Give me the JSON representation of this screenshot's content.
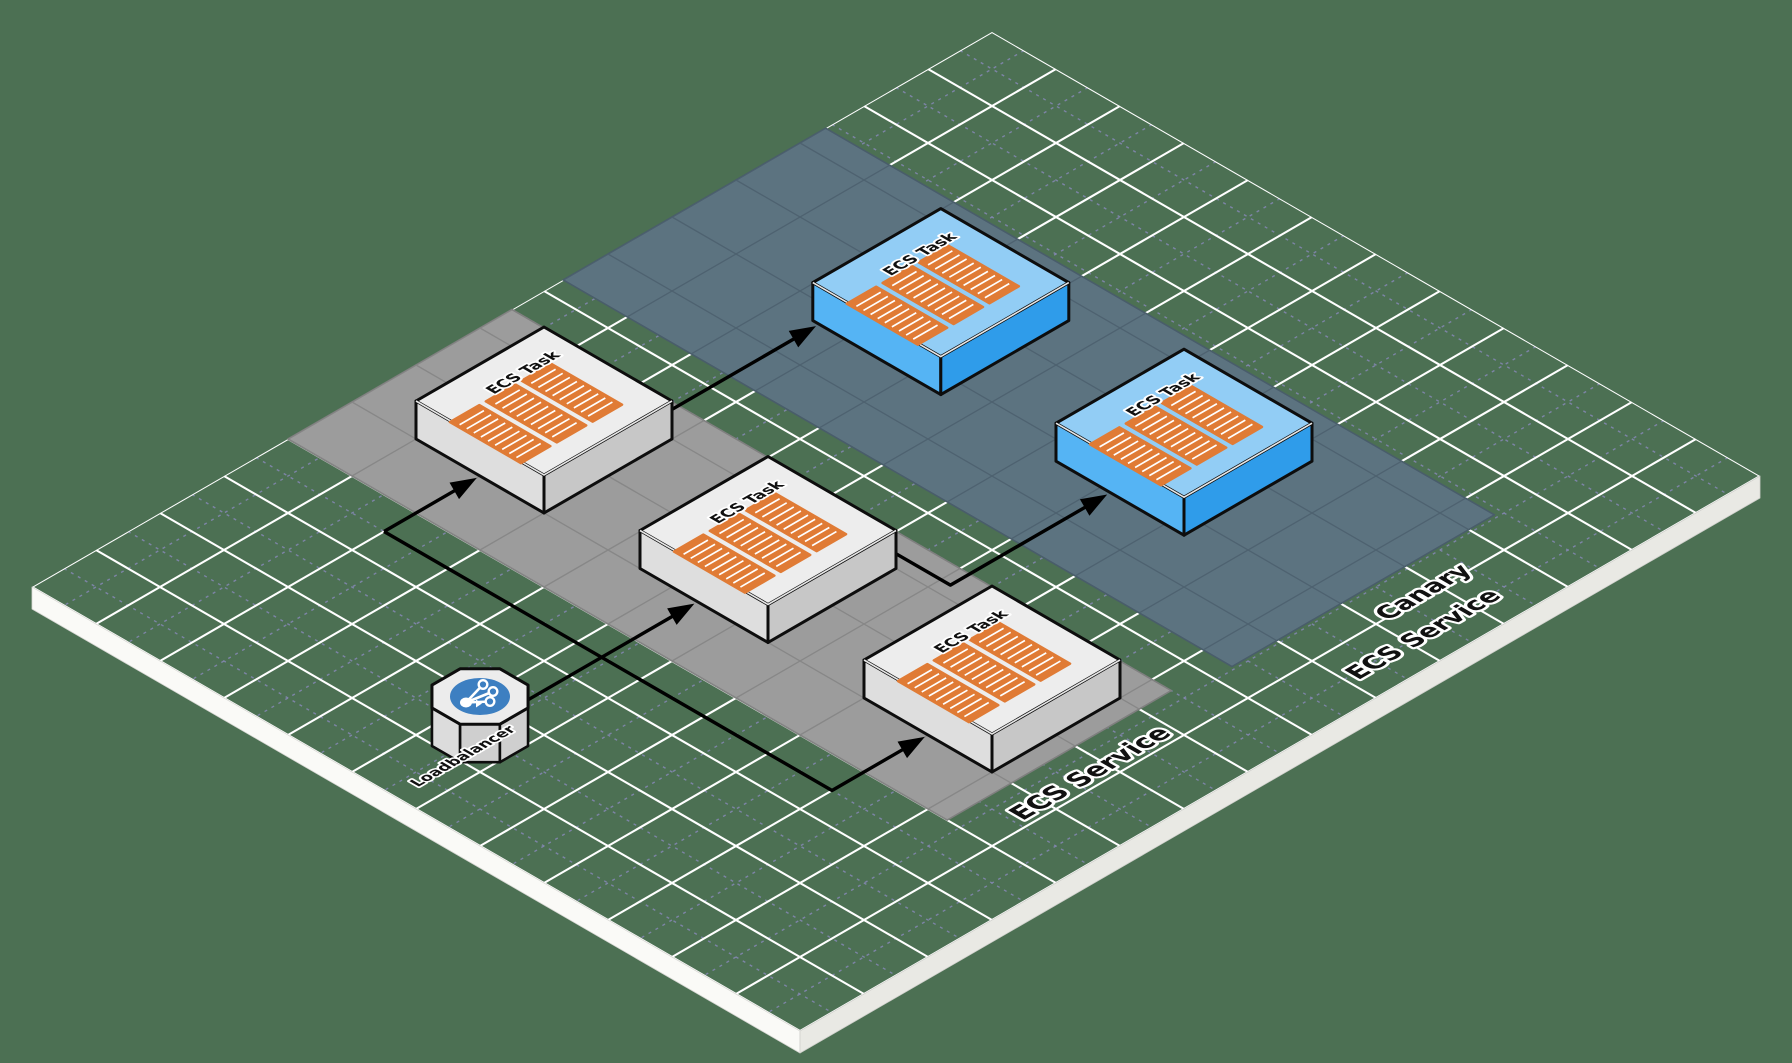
{
  "diagram": {
    "background_color": "#4c7053",
    "grid": {
      "major_line_color": "#ffffff",
      "minor_line_color": "#8387b0",
      "edge_left_color": "#fafaf7",
      "edge_right_color": "#e9e9e4"
    },
    "zones": [
      {
        "id": "ecs-service",
        "label": "ECS Service",
        "fill": "#9c9c9c",
        "grid_color": "#878787",
        "border_color": "#7f7f7f"
      },
      {
        "id": "canary-ecs-service",
        "label": "Canary ECS Service",
        "label_lines": [
          "Canary",
          "ECS Service"
        ],
        "fill": "#5c7380",
        "grid_color": "#4e6270",
        "border_color": "#495d6a"
      }
    ],
    "nodes": [
      {
        "id": "ecs-task-1",
        "label": "ECS Task",
        "type": "ecs-task",
        "zone": "ecs-service",
        "icon": "container-stack-icon"
      },
      {
        "id": "ecs-task-2",
        "label": "ECS Task",
        "type": "ecs-task",
        "zone": "ecs-service",
        "icon": "container-stack-icon"
      },
      {
        "id": "ecs-task-3",
        "label": "ECS Task",
        "type": "ecs-task",
        "zone": "ecs-service",
        "icon": "container-stack-icon"
      },
      {
        "id": "canary-ecs-task-1",
        "label": "ECS Task",
        "type": "ecs-task-canary",
        "zone": "canary-ecs-service",
        "icon": "container-stack-icon"
      },
      {
        "id": "canary-ecs-task-2",
        "label": "ECS Task",
        "type": "ecs-task-canary",
        "zone": "canary-ecs-service",
        "icon": "container-stack-icon"
      },
      {
        "id": "loadbalancer",
        "label": "Loadbalancer",
        "type": "load-balancer",
        "zone": null,
        "icon": "load-balancer-icon"
      }
    ],
    "edges": [
      {
        "from": "loadbalancer",
        "to": "ecs-task-1"
      },
      {
        "from": "loadbalancer",
        "to": "ecs-task-2"
      },
      {
        "from": "loadbalancer",
        "to": "ecs-task-3"
      },
      {
        "from": "loadbalancer",
        "to": "canary-ecs-task-1"
      },
      {
        "from": "loadbalancer",
        "to": "canary-ecs-task-2"
      }
    ],
    "node_colors": {
      "ecs_task": {
        "top": "#ededed",
        "left": "#dedede",
        "right": "#c7c7c7",
        "outline": "#0d0d0d",
        "label_color": "#111111"
      },
      "ecs_task_canary": {
        "top": "#92cdf5",
        "left": "#55b4f4",
        "right": "#2f9cea",
        "outline": "#0d0d0d",
        "label_color": "#111111"
      },
      "container": {
        "border": "#e07b35",
        "fill": "#e07b35",
        "stripe": "#ffffff"
      },
      "load_balancer": {
        "top": "#ececec",
        "side_left": "#dcdcdc",
        "side_mid": "#cfcfcf",
        "side_right": "#c2c2c2",
        "badge": "#3d7fc1",
        "glyph": "#ffffff"
      }
    },
    "arrow_color": "#000000"
  }
}
